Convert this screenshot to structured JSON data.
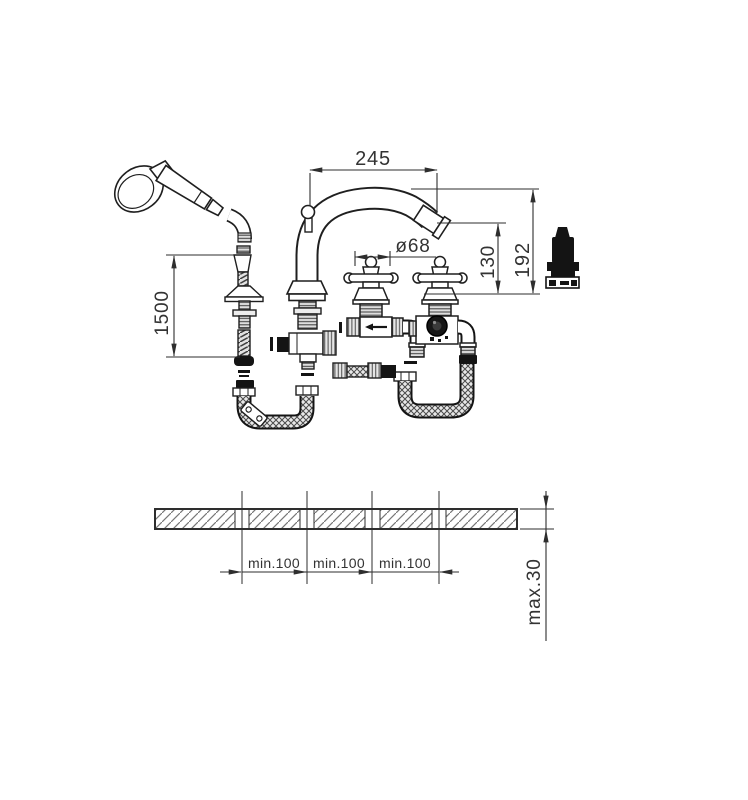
{
  "drawing": {
    "kind": "bath-mixer-installation-dimension-drawing",
    "labels": {
      "spout_projection": "245",
      "handle_diameter": "ø68",
      "spout_outlet_height": "130",
      "spout_top_height": "192",
      "shower_hose_length": "1500",
      "hole_spacing": [
        "min.100",
        "min.100",
        "min.100"
      ],
      "deck_max_thickness": "max.30"
    },
    "colors": {
      "line": "#2e2e2e",
      "text": "#333333",
      "solid_fill": "#141414",
      "hatch": "#777777"
    }
  }
}
